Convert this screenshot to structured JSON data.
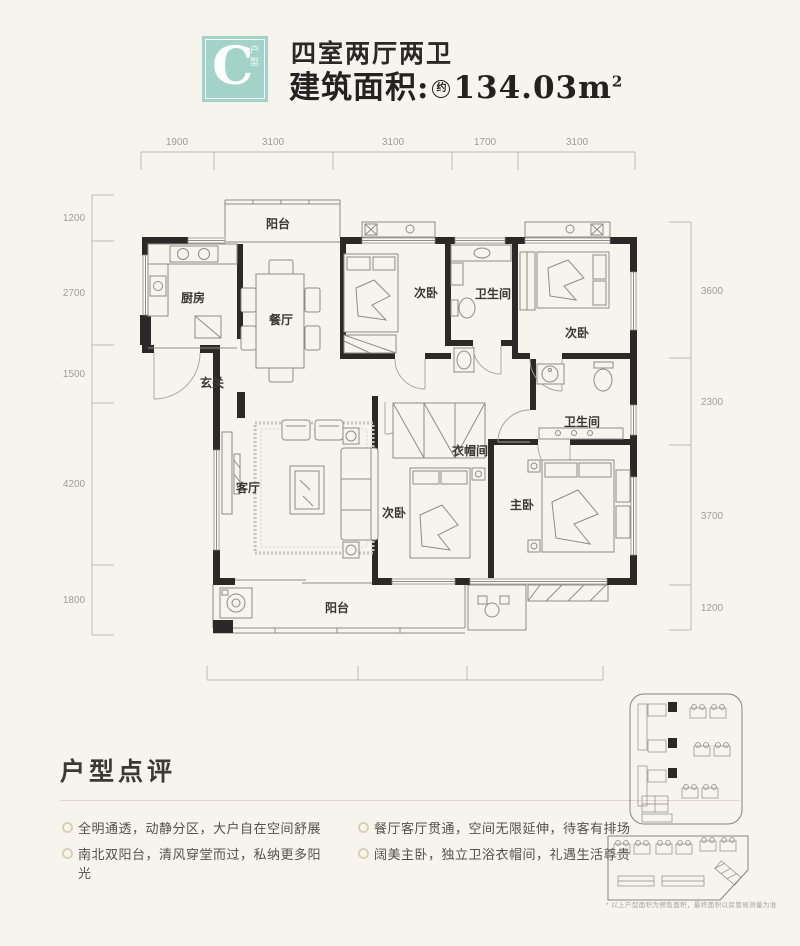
{
  "colors": {
    "accent_teal": "#a3d2c8",
    "wall": "#2b2927",
    "background": "#f7f4ee"
  },
  "header": {
    "unit_letter": "C",
    "unit_tag": "户型",
    "title": "四室两厅两卫",
    "area_prefix": "建筑面积:",
    "area_approx": "约",
    "area_value": "134.03m",
    "area_sup": "2"
  },
  "plan": {
    "rooms": {
      "balcony_north": "阳台",
      "kitchen": "厨房",
      "dining": "餐厅",
      "bedroom_a": "次卧",
      "bath_a": "卫生间",
      "bedroom_b": "次卧",
      "entry": "玄关",
      "living": "客厅",
      "bedroom_c": "次卧",
      "cloakroom": "衣帽间",
      "bath_b": "卫生间",
      "master": "主卧",
      "balcony_south": "阳台"
    },
    "dimensions": {
      "top": [
        "1900",
        "3100",
        "3100",
        "1700",
        "3100"
      ],
      "left": [
        "1200",
        "2700",
        "1500",
        "4200",
        "1800"
      ],
      "right": [
        "3600",
        "2300",
        "3700",
        "1200"
      ],
      "bottom": [
        "4200",
        "3000",
        "3800"
      ]
    }
  },
  "review": {
    "title": "户型点评",
    "bullets_left": [
      "全明通透，动静分区，大户自在空间舒展",
      "南北双阳台，清风穿堂而过，私纳更多阳光"
    ],
    "bullets_right": [
      "餐厅客厅贯通，空间无限延伸，待客有排场",
      "阔美主卧，独立卫浴衣帽间，礼遇生活尊贵"
    ]
  },
  "sitemap": {
    "disclaimer": "* 以上户型面积为预售面积，最终面积以房管局测量为准"
  }
}
